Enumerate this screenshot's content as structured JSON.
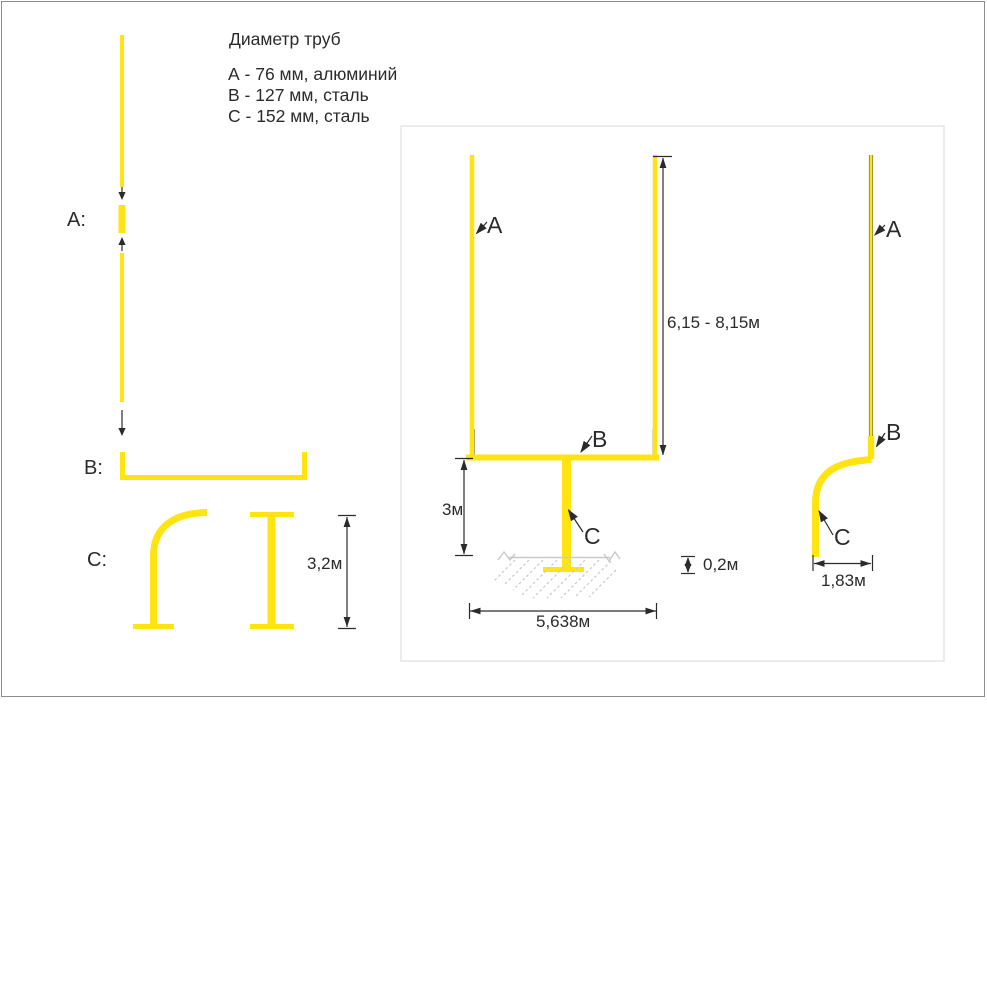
{
  "legend": {
    "title": "Диаметр труб",
    "items": [
      "А - 76 мм, алюминий",
      "В - 127 мм, сталь",
      "С - 152 мм, сталь"
    ]
  },
  "parts": {
    "a_label": "А:",
    "b_label": "В:",
    "c_label": "С:",
    "c_height_dim": "3,2м"
  },
  "front_view": {
    "label_a": "A",
    "label_b": "B",
    "label_c": "C",
    "dim_upright_height": "6,15 - 8,15м",
    "dim_post_height": "3м",
    "dim_width": "5,638м",
    "dim_foundation_depth": "0,2м"
  },
  "side_view": {
    "label_a": "A",
    "label_b": "B",
    "label_c": "C",
    "dim_base_offset": "1,83м"
  },
  "colors": {
    "pipe": "#ffe412",
    "ink": "#2b2b2b",
    "ground": "#c9c9c9",
    "box_border": "#e6e6e6",
    "page_border": "#8c8c8c"
  }
}
